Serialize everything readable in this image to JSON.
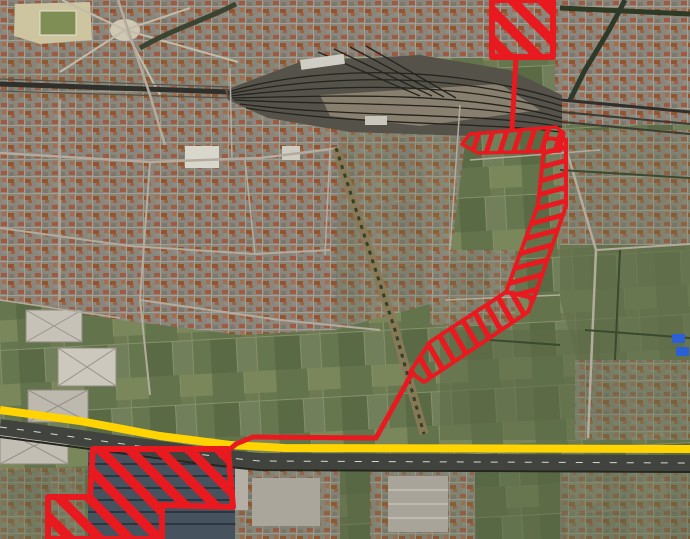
{
  "map": {
    "kind": "aerial-imagery-with-planning-overlay",
    "colors": {
      "zone_red": "#e8191f",
      "route_yellow": "#ffd400"
    },
    "overlay": {
      "zones": [
        {
          "id": "north-site",
          "hatch": "diag",
          "weight": 6,
          "points": [
            [
              492,
              0
            ],
            [
              553,
              0
            ],
            [
              553,
              57
            ],
            [
              492,
              57
            ]
          ]
        },
        {
          "id": "station-strip",
          "hatch": "rung-h",
          "weight": 3.5,
          "points": [
            [
              462,
              144
            ],
            [
              470,
              134
            ],
            [
              556,
              127
            ],
            [
              564,
              133
            ],
            [
              560,
              151
            ],
            [
              478,
              153
            ]
          ]
        },
        {
          "id": "corridor-north",
          "hatch": "rung-v",
          "weight": 4,
          "points": [
            [
              545,
              138
            ],
            [
              566,
              140
            ],
            [
              566,
              206
            ],
            [
              534,
              298
            ],
            [
              506,
              292
            ],
            [
              538,
              205
            ]
          ]
        },
        {
          "id": "corridor-southwest",
          "hatch": "rung-sw",
          "weight": 4,
          "points": [
            [
              534,
              298
            ],
            [
              528,
              312
            ],
            [
              424,
              382
            ],
            [
              410,
              372
            ],
            [
              430,
              342
            ],
            [
              506,
              292
            ]
          ]
        },
        {
          "id": "south-site",
          "hatch": "diag",
          "weight": 6,
          "points": [
            [
              93,
              449
            ],
            [
              228,
              449
            ],
            [
              233,
              507
            ],
            [
              162,
              505
            ],
            [
              162,
              539
            ],
            [
              48,
              539
            ],
            [
              48,
              497
            ],
            [
              90,
              497
            ]
          ]
        }
      ],
      "links": [
        {
          "id": "north-link",
          "weight": 5,
          "points": [
            [
              516,
              57
            ],
            [
              512,
              130
            ]
          ]
        },
        {
          "id": "south-link",
          "weight": 5,
          "points": [
            [
              411,
              375
            ],
            [
              376,
              438
            ],
            [
              253,
              437
            ],
            [
              236,
              444
            ],
            [
              228,
              451
            ]
          ]
        }
      ],
      "route": {
        "id": "route-line",
        "weight": 8,
        "points": [
          [
            0,
            410
          ],
          [
            80,
            421
          ],
          [
            160,
            436
          ],
          [
            230,
            445
          ],
          [
            285,
            448
          ],
          [
            690,
            449
          ]
        ]
      }
    }
  }
}
